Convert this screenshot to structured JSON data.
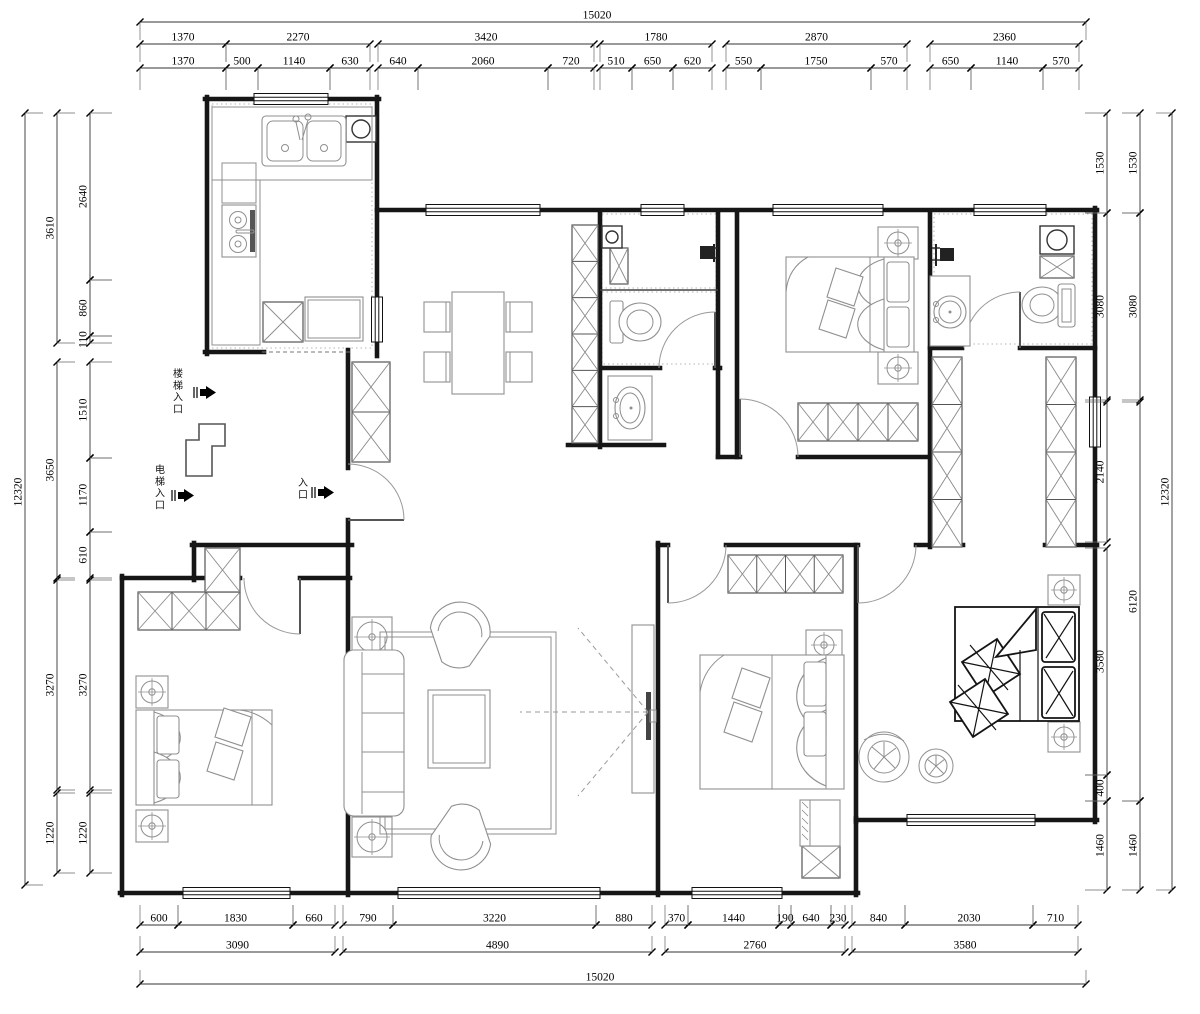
{
  "labels": [
    {
      "text": "楼梯入口",
      "x": 178,
      "y": 377,
      "size": 10
    },
    {
      "text": "电梯入口",
      "x": 160,
      "y": 473,
      "size": 10
    },
    {
      "text": "入口",
      "x": 303,
      "y": 486,
      "size": 10
    },
    {
      "text": "洗衣机",
      "x": 821,
      "y": 808,
      "size": 8.5
    },
    {
      "text": "冰箱",
      "x": 334,
      "y": 308,
      "size": 7
    }
  ],
  "arrows": [
    {
      "x": 194,
      "y": 386
    },
    {
      "x": 172,
      "y": 489
    },
    {
      "x": 312,
      "y": 486
    }
  ],
  "dims": {
    "h_chains": [
      {
        "pos": 22,
        "ext": 18,
        "segs": [
          [
            "15020",
            140,
            1086,
            597
          ]
        ]
      },
      {
        "pos": 44,
        "ext": 18,
        "segs": [
          [
            "1370",
            140,
            226
          ],
          [
            "2270",
            226,
            370
          ],
          [
            "3420",
            378,
            594
          ],
          [
            "1780",
            600,
            712
          ],
          [
            "2870",
            726,
            907
          ],
          [
            "2360",
            930,
            1079
          ]
        ]
      },
      {
        "pos": 68,
        "ext": 22,
        "segs": [
          [
            "1370",
            140,
            226
          ],
          [
            "500",
            226,
            258
          ],
          [
            "1140",
            258,
            330
          ],
          [
            "630",
            330,
            370
          ],
          [
            "640",
            378,
            418
          ],
          [
            "2060",
            418,
            548
          ],
          [
            "720",
            548,
            594
          ],
          [
            "510",
            600,
            632
          ],
          [
            "650",
            632,
            673
          ],
          [
            "620",
            673,
            712
          ],
          [
            "550",
            726,
            761
          ],
          [
            "1750",
            761,
            871
          ],
          [
            "570",
            871,
            907
          ],
          [
            "650",
            930,
            971
          ],
          [
            "1140",
            971,
            1043
          ],
          [
            "570",
            1043,
            1079
          ]
        ]
      },
      {
        "pos": 925,
        "ext": -20,
        "segs": [
          [
            "600",
            140,
            178
          ],
          [
            "1830",
            178,
            293
          ],
          [
            "660",
            293,
            335
          ],
          [
            "790",
            343,
            393
          ],
          [
            "3220",
            393,
            596
          ],
          [
            "880",
            596,
            652
          ],
          [
            "370",
            665,
            688
          ],
          [
            "1440",
            688,
            779
          ],
          [
            "190",
            779,
            791
          ],
          [
            "640",
            791,
            831
          ],
          [
            "230",
            831,
            845
          ],
          [
            "840",
            852,
            905
          ],
          [
            "2030",
            905,
            1033
          ],
          [
            "710",
            1033,
            1078
          ]
        ]
      },
      {
        "pos": 952,
        "ext": -16,
        "segs": [
          [
            "3090",
            140,
            335
          ],
          [
            "4890",
            343,
            652
          ],
          [
            "2760",
            665,
            845
          ],
          [
            "3580",
            852,
            1078
          ]
        ]
      },
      {
        "pos": 984,
        "ext": -14,
        "segs": [
          [
            "15020",
            140,
            1086,
            600
          ]
        ]
      }
    ],
    "v_chains": [
      {
        "pos": 25,
        "ext": 18,
        "segs": [
          [
            "12320",
            113,
            885,
            492
          ]
        ]
      },
      {
        "pos": 57,
        "ext": 18,
        "segs": [
          [
            "3610",
            113,
            343
          ],
          [
            "3650",
            362,
            578
          ],
          [
            "3270",
            580,
            790
          ],
          [
            "1220",
            793,
            873
          ]
        ]
      },
      {
        "pos": 90,
        "ext": 22,
        "segs": [
          [
            "2640",
            113,
            280
          ],
          [
            "860",
            280,
            336
          ],
          [
            "110",
            336,
            343
          ],
          [
            "1510",
            362,
            458
          ],
          [
            "1170",
            458,
            532
          ],
          [
            "610",
            532,
            578
          ],
          [
            "3270",
            580,
            790
          ],
          [
            "1220",
            793,
            873
          ]
        ]
      },
      {
        "pos": 1107,
        "ext": -22,
        "segs": [
          [
            "1530",
            113,
            213
          ],
          [
            "3080",
            213,
            400
          ],
          [
            "2140",
            402,
            542
          ],
          [
            "3580",
            548,
            775
          ],
          [
            "400",
            775,
            801
          ],
          [
            "1460",
            801,
            890
          ]
        ]
      },
      {
        "pos": 1140,
        "ext": -18,
        "segs": [
          [
            "1530",
            113,
            213
          ],
          [
            "3080",
            213,
            400
          ],
          [
            "6120",
            402,
            801
          ],
          [
            "1460",
            801,
            890
          ]
        ]
      },
      {
        "pos": 1172,
        "ext": -16,
        "segs": [
          [
            "12320",
            113,
            890,
            492
          ]
        ]
      }
    ]
  },
  "plan": {
    "walls": [
      [
        205,
        99,
        254,
        99
      ],
      [
        328,
        99,
        379,
        99
      ],
      [
        207,
        97,
        207,
        354
      ],
      [
        205,
        352,
        264,
        352
      ],
      [
        348,
        350,
        348,
        468
      ],
      [
        348,
        520,
        348,
        895
      ],
      [
        352,
        545,
        192,
        545
      ],
      [
        194,
        543,
        194,
        580
      ],
      [
        122,
        578,
        240,
        578
      ],
      [
        300,
        578,
        350,
        578
      ],
      [
        122,
        576,
        122,
        895
      ],
      [
        120,
        893,
        183,
        893
      ],
      [
        290,
        893,
        398,
        893
      ],
      [
        600,
        893,
        692,
        893
      ],
      [
        782,
        893,
        858,
        893
      ],
      [
        856,
        895,
        856,
        818
      ],
      [
        856,
        820,
        907,
        820
      ],
      [
        1035,
        820,
        1097,
        820
      ],
      [
        1095,
        822,
        1095,
        447
      ],
      [
        1095,
        395,
        1095,
        208
      ],
      [
        377,
        210,
        426,
        210
      ],
      [
        540,
        210,
        641,
        210
      ],
      [
        684,
        210,
        773,
        210
      ],
      [
        883,
        210,
        974,
        210
      ],
      [
        1046,
        210,
        1097,
        210
      ],
      [
        377,
        97,
        377,
        297
      ],
      [
        377,
        342,
        377,
        356
      ],
      [
        600,
        212,
        600,
        447
      ],
      [
        718,
        212,
        718,
        457
      ],
      [
        737,
        212,
        737,
        457
      ],
      [
        568,
        445,
        664,
        445
      ],
      [
        718,
        457,
        740,
        457
      ],
      [
        798,
        457,
        932,
        457
      ],
      [
        930,
        212,
        930,
        547
      ],
      [
        602,
        368,
        660,
        368
      ],
      [
        715,
        368,
        720,
        368
      ],
      [
        658,
        545,
        668,
        545
      ],
      [
        726,
        545,
        858,
        545
      ],
      [
        916,
        545,
        963,
        545
      ],
      [
        1045,
        545,
        1097,
        545
      ],
      [
        658,
        543,
        658,
        895
      ],
      [
        856,
        545,
        856,
        822
      ],
      [
        930,
        348,
        962,
        348
      ],
      [
        1020,
        348,
        1095,
        348
      ]
    ],
    "thin": [
      [
        600,
        290,
        718,
        290
      ]
    ],
    "dashed": [
      [
        262,
        352,
        352,
        352
      ]
    ],
    "windows_h": [
      [
        254,
        99,
        74
      ],
      [
        426,
        210,
        114
      ],
      [
        641,
        210,
        43
      ],
      [
        773,
        210,
        110
      ],
      [
        974,
        210,
        72
      ],
      [
        183,
        893,
        107
      ],
      [
        398,
        893,
        202
      ],
      [
        692,
        893,
        90
      ],
      [
        907,
        820,
        128
      ]
    ],
    "windows_v": [
      [
        377,
        297,
        45
      ],
      [
        1095,
        397,
        50
      ]
    ],
    "doors": [
      {
        "leaf": [
          348,
          520,
          404,
          520
        ],
        "arc": "M404,520 A56,56 0 0 0 348,464"
      },
      {
        "leaf": [
          300,
          578,
          300,
          634
        ],
        "arc": "M300,634 A56,56 0 0 1 244,578"
      },
      {
        "leaf": [
          668,
          545,
          668,
          603
        ],
        "arc": "M668,603 A58,58 0 0 0 726,545"
      },
      {
        "leaf": [
          858,
          545,
          858,
          603
        ],
        "arc": "M916,545 A58,58 0 0 1 858,603"
      },
      {
        "leaf": [
          740,
          457,
          740,
          399
        ],
        "arc": "M740,399 A58,58 0 0 1 798,457"
      },
      {
        "leaf": [
          715,
          368,
          715,
          312
        ],
        "arc": "M715,312 A56,56 0 0 0 659,368"
      },
      {
        "leaf": [
          1020,
          348,
          1020,
          292
        ],
        "arc": "M1020,292 A56,56 0 0 0 964,348"
      }
    ],
    "xboxes": [
      [
        263,
        302,
        40,
        40,
        1
      ],
      [
        352,
        362,
        38,
        100,
        2
      ],
      [
        572,
        225,
        26,
        218,
        6
      ],
      [
        610,
        248,
        18,
        36,
        1
      ],
      [
        798,
        403,
        120,
        38,
        4
      ],
      [
        1040,
        256,
        34,
        22,
        1
      ],
      [
        932,
        357,
        30,
        190,
        4
      ],
      [
        1046,
        357,
        30,
        190,
        4
      ],
      [
        138,
        592,
        102,
        38,
        3
      ],
      [
        205,
        548,
        35,
        44,
        1
      ],
      [
        728,
        555,
        115,
        38,
        4
      ],
      [
        802,
        846,
        38,
        32,
        1
      ],
      [
        636,
        648,
        16,
        22,
        1
      ],
      [
        636,
        748,
        16,
        22,
        1
      ]
    ],
    "ducts": [
      [
        602,
        226,
        20,
        22
      ],
      [
        1040,
        226,
        34,
        28
      ],
      [
        346,
        116,
        30,
        26
      ]
    ],
    "nightstands": [
      [
        136,
        676,
        32,
        32
      ],
      [
        136,
        810,
        32,
        32
      ],
      [
        352,
        617,
        40,
        40
      ],
      [
        352,
        817,
        40,
        40
      ],
      [
        878,
        227,
        40,
        32
      ],
      [
        878,
        352,
        40,
        32
      ],
      [
        806,
        630,
        36,
        30
      ],
      [
        806,
        758,
        36,
        30
      ],
      [
        1048,
        575,
        32,
        30
      ],
      [
        1048,
        722,
        32,
        30
      ]
    ],
    "tiles": [
      [
        212,
        104,
        160,
        244
      ],
      [
        602,
        214,
        114,
        74
      ],
      [
        602,
        292,
        114,
        72
      ],
      [
        934,
        214,
        158,
        130
      ]
    ],
    "sight_lines": [
      [
        648,
        712,
        520,
        712
      ],
      [
        648,
        712,
        578,
        628
      ],
      [
        648,
        712,
        578,
        796
      ]
    ]
  }
}
